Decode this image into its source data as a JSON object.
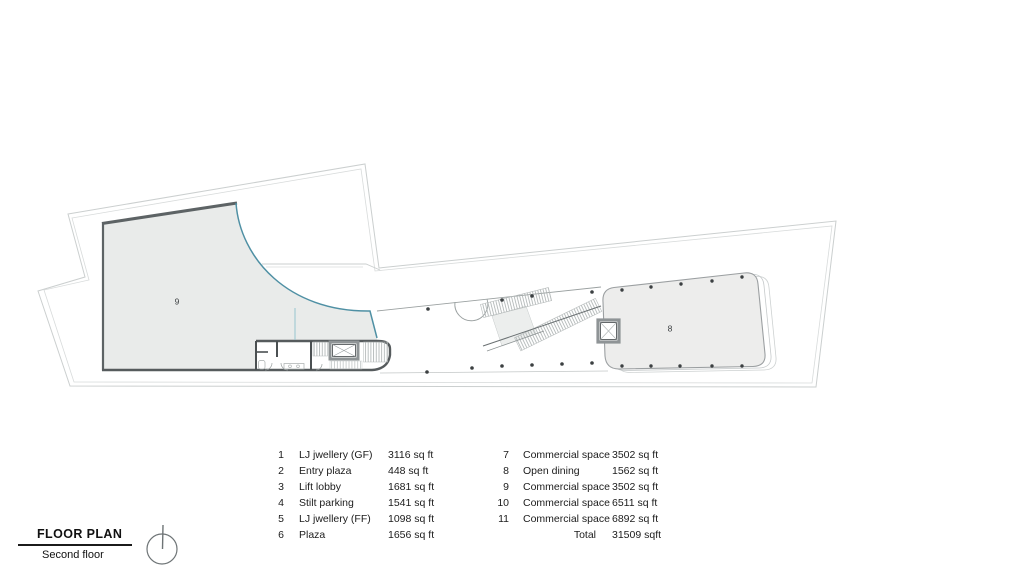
{
  "title_block": {
    "title": "FLOOR PLAN",
    "subtitle": "Second floor"
  },
  "plan": {
    "room_labels": {
      "room9": "9",
      "room8": "8"
    },
    "colors": {
      "facade_teal": "#4f90a4",
      "room9_fill": "#e9ebea",
      "room8_fill": "#ededec",
      "wall_dark": "#5d6365",
      "site_line": "#cbcfcf"
    }
  },
  "legend": {
    "left": [
      {
        "no": "1",
        "name": "LJ jwellery (GF)",
        "area": "3116 sq ft"
      },
      {
        "no": "2",
        "name": "Entry plaza",
        "area": "448 sq ft"
      },
      {
        "no": "3",
        "name": "Lift lobby",
        "area": "1681 sq ft"
      },
      {
        "no": "4",
        "name": "Stilt parking",
        "area": "1541 sq ft"
      },
      {
        "no": "5",
        "name": "LJ jwellery (FF)",
        "area": "1098 sq ft"
      },
      {
        "no": "6",
        "name": "Plaza",
        "area": "1656 sq ft"
      }
    ],
    "right": [
      {
        "no": "7",
        "name": "Commercial space",
        "area": "3502 sq ft"
      },
      {
        "no": "8",
        "name": "Open dining",
        "area": "1562 sq ft"
      },
      {
        "no": "9",
        "name": "Commercial space",
        "area": "3502 sq ft"
      },
      {
        "no": "10",
        "name": "Commercial space",
        "area": "6511 sq ft"
      },
      {
        "no": "11",
        "name": "Commercial space",
        "area": "6892 sq ft"
      }
    ],
    "total": {
      "label": "Total",
      "value": "31509 sqft"
    }
  }
}
